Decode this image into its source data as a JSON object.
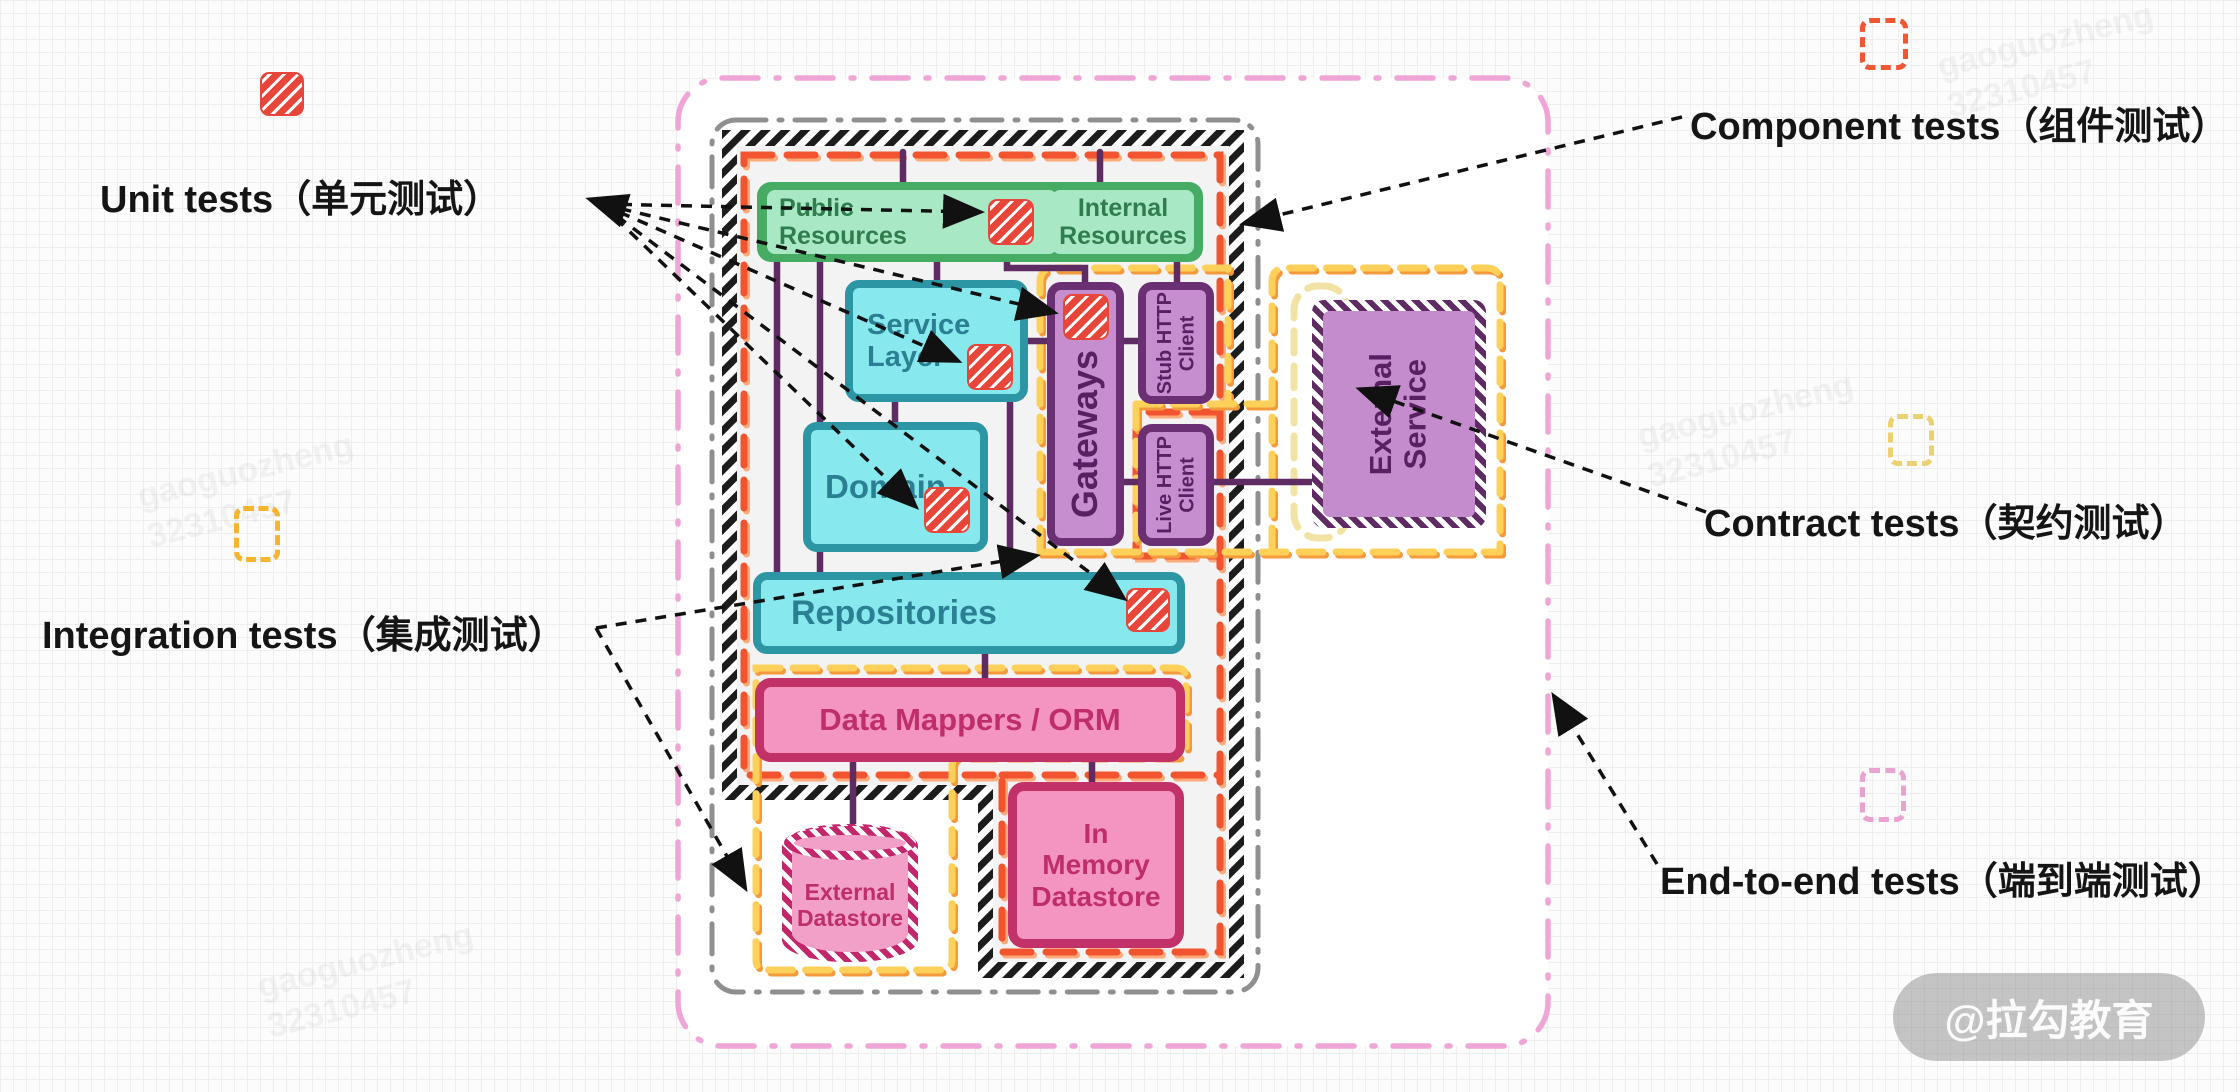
{
  "legend": {
    "unit": {
      "label": "Unit tests（单元测试）",
      "icon": "red-hatched-square",
      "color": "#e8463a"
    },
    "component": {
      "label": "Component tests（组件测试）",
      "icon": "orange-dashed-square",
      "color": "#f25633"
    },
    "contract": {
      "label": "Contract tests（契约测试）",
      "icon": "yellow-dashed-square",
      "color": "#ecd170"
    },
    "integration": {
      "label": "Integration tests（集成测试）",
      "icon": "amber-dashed-square",
      "color": "#f7b42c"
    },
    "e2e": {
      "label": "End-to-end tests（端到端测试）",
      "icon": "pink-dashed-square",
      "color": "#eaa3d1"
    }
  },
  "boxes": {
    "public_resources": "Public\nResources",
    "internal_resources": "Internal\nResources",
    "service_layer": "Service\nLayer",
    "domain": "Domain",
    "gateways": "Gateways",
    "stub_http_client": "Stub HTTP\nClient",
    "live_http_client": "Live HTTP\nClient",
    "external_service": "External\nService",
    "repositories": "Repositories",
    "data_mappers_orm": "Data Mappers / ORM",
    "external_datastore": "External\nDatastore",
    "in_memory_datastore": "In\nMemory\nDatastore"
  },
  "boundaries": {
    "end_to_end_color": "#f0a5d7",
    "system_color": "#8f8f8f",
    "component_color": "#f2542f",
    "integration_color": "#fdd05a",
    "hatched_band": "black-white-diagonal"
  },
  "watermark": {
    "badge": "@拉勾教育",
    "tile_line1": "gaoguozheng",
    "tile_line2": "32310457"
  }
}
